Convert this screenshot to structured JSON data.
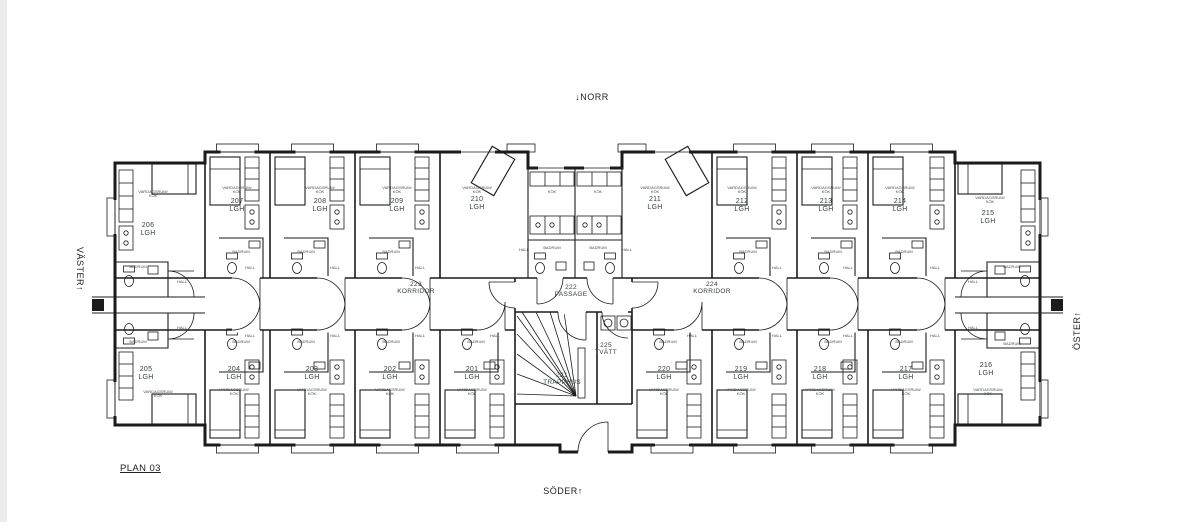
{
  "plan_title": "PLAN 03",
  "compass": {
    "north": "NORR",
    "north_arrow": "↓",
    "south": "SÖDER",
    "south_arrow": "↑",
    "west": "VÄSTER",
    "west_arrow": "↑",
    "east": "ÖSTER",
    "east_arrow": "↑"
  },
  "unit_label": "LGH",
  "room_labels": {
    "living_line1": "VARDAGSRUM/",
    "living_line2": "KÖK",
    "bath": "BADRUM",
    "hall": "HALL",
    "kitchen": "KÖK"
  },
  "apartments": [
    {
      "number": "201"
    },
    {
      "number": "202"
    },
    {
      "number": "203"
    },
    {
      "number": "204"
    },
    {
      "number": "205"
    },
    {
      "number": "206"
    },
    {
      "number": "207"
    },
    {
      "number": "208"
    },
    {
      "number": "209"
    },
    {
      "number": "210"
    },
    {
      "number": "211"
    },
    {
      "number": "212"
    },
    {
      "number": "213"
    },
    {
      "number": "214"
    },
    {
      "number": "215"
    },
    {
      "number": "216"
    },
    {
      "number": "217"
    },
    {
      "number": "218"
    },
    {
      "number": "219"
    },
    {
      "number": "220"
    }
  ],
  "common_rooms": [
    {
      "number": "221",
      "name": "TRAPPHUS"
    },
    {
      "number": "222",
      "name": "PASSAGE"
    },
    {
      "number": "223",
      "name": "KORRIDOR"
    },
    {
      "number": "224",
      "name": "KORRIDOR"
    },
    {
      "number": "225",
      "name": "TVÄTT"
    }
  ],
  "colors": {
    "wall": "#1b1b1b",
    "text": "#374040",
    "background": "#ffffff"
  }
}
